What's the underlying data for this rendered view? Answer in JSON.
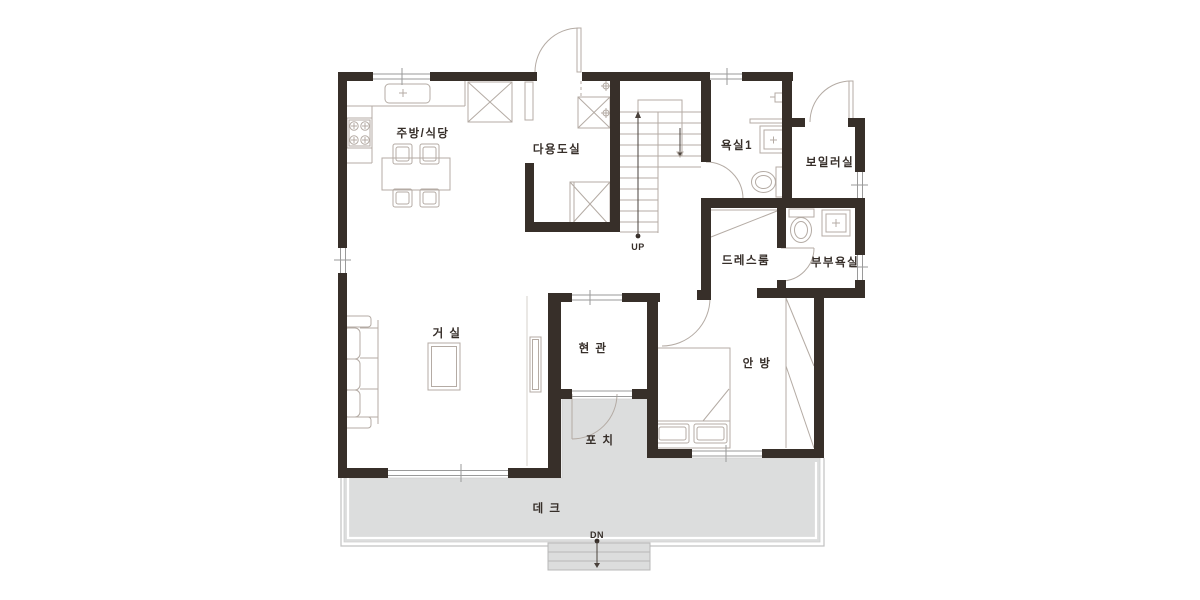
{
  "plan": {
    "type": "residential-floor-plan",
    "floor": "1F"
  },
  "colors": {
    "wall": "#372f29",
    "furniture_line": "#b4aba4",
    "deck_fill": "#dcdddd",
    "deck_edge": "#c2c2c2",
    "label_text": "#362e29",
    "background": "#ffffff"
  },
  "rooms": {
    "kitchen_dining": {
      "label": "주방/식당"
    },
    "utility": {
      "label": "다용도실"
    },
    "bathroom1": {
      "label": "욕실1"
    },
    "boiler": {
      "label": "보일러실"
    },
    "dressroom": {
      "label": "드레스룸"
    },
    "master_bathroom": {
      "label": "부부욕실"
    },
    "living": {
      "label": "거 실"
    },
    "entrance": {
      "label": "현 관"
    },
    "master_bedroom": {
      "label": "안 방"
    },
    "porch": {
      "label": "포 치"
    },
    "deck": {
      "label": "데 크"
    }
  },
  "stairs": {
    "up_label": "UP",
    "down_label": "DN"
  }
}
